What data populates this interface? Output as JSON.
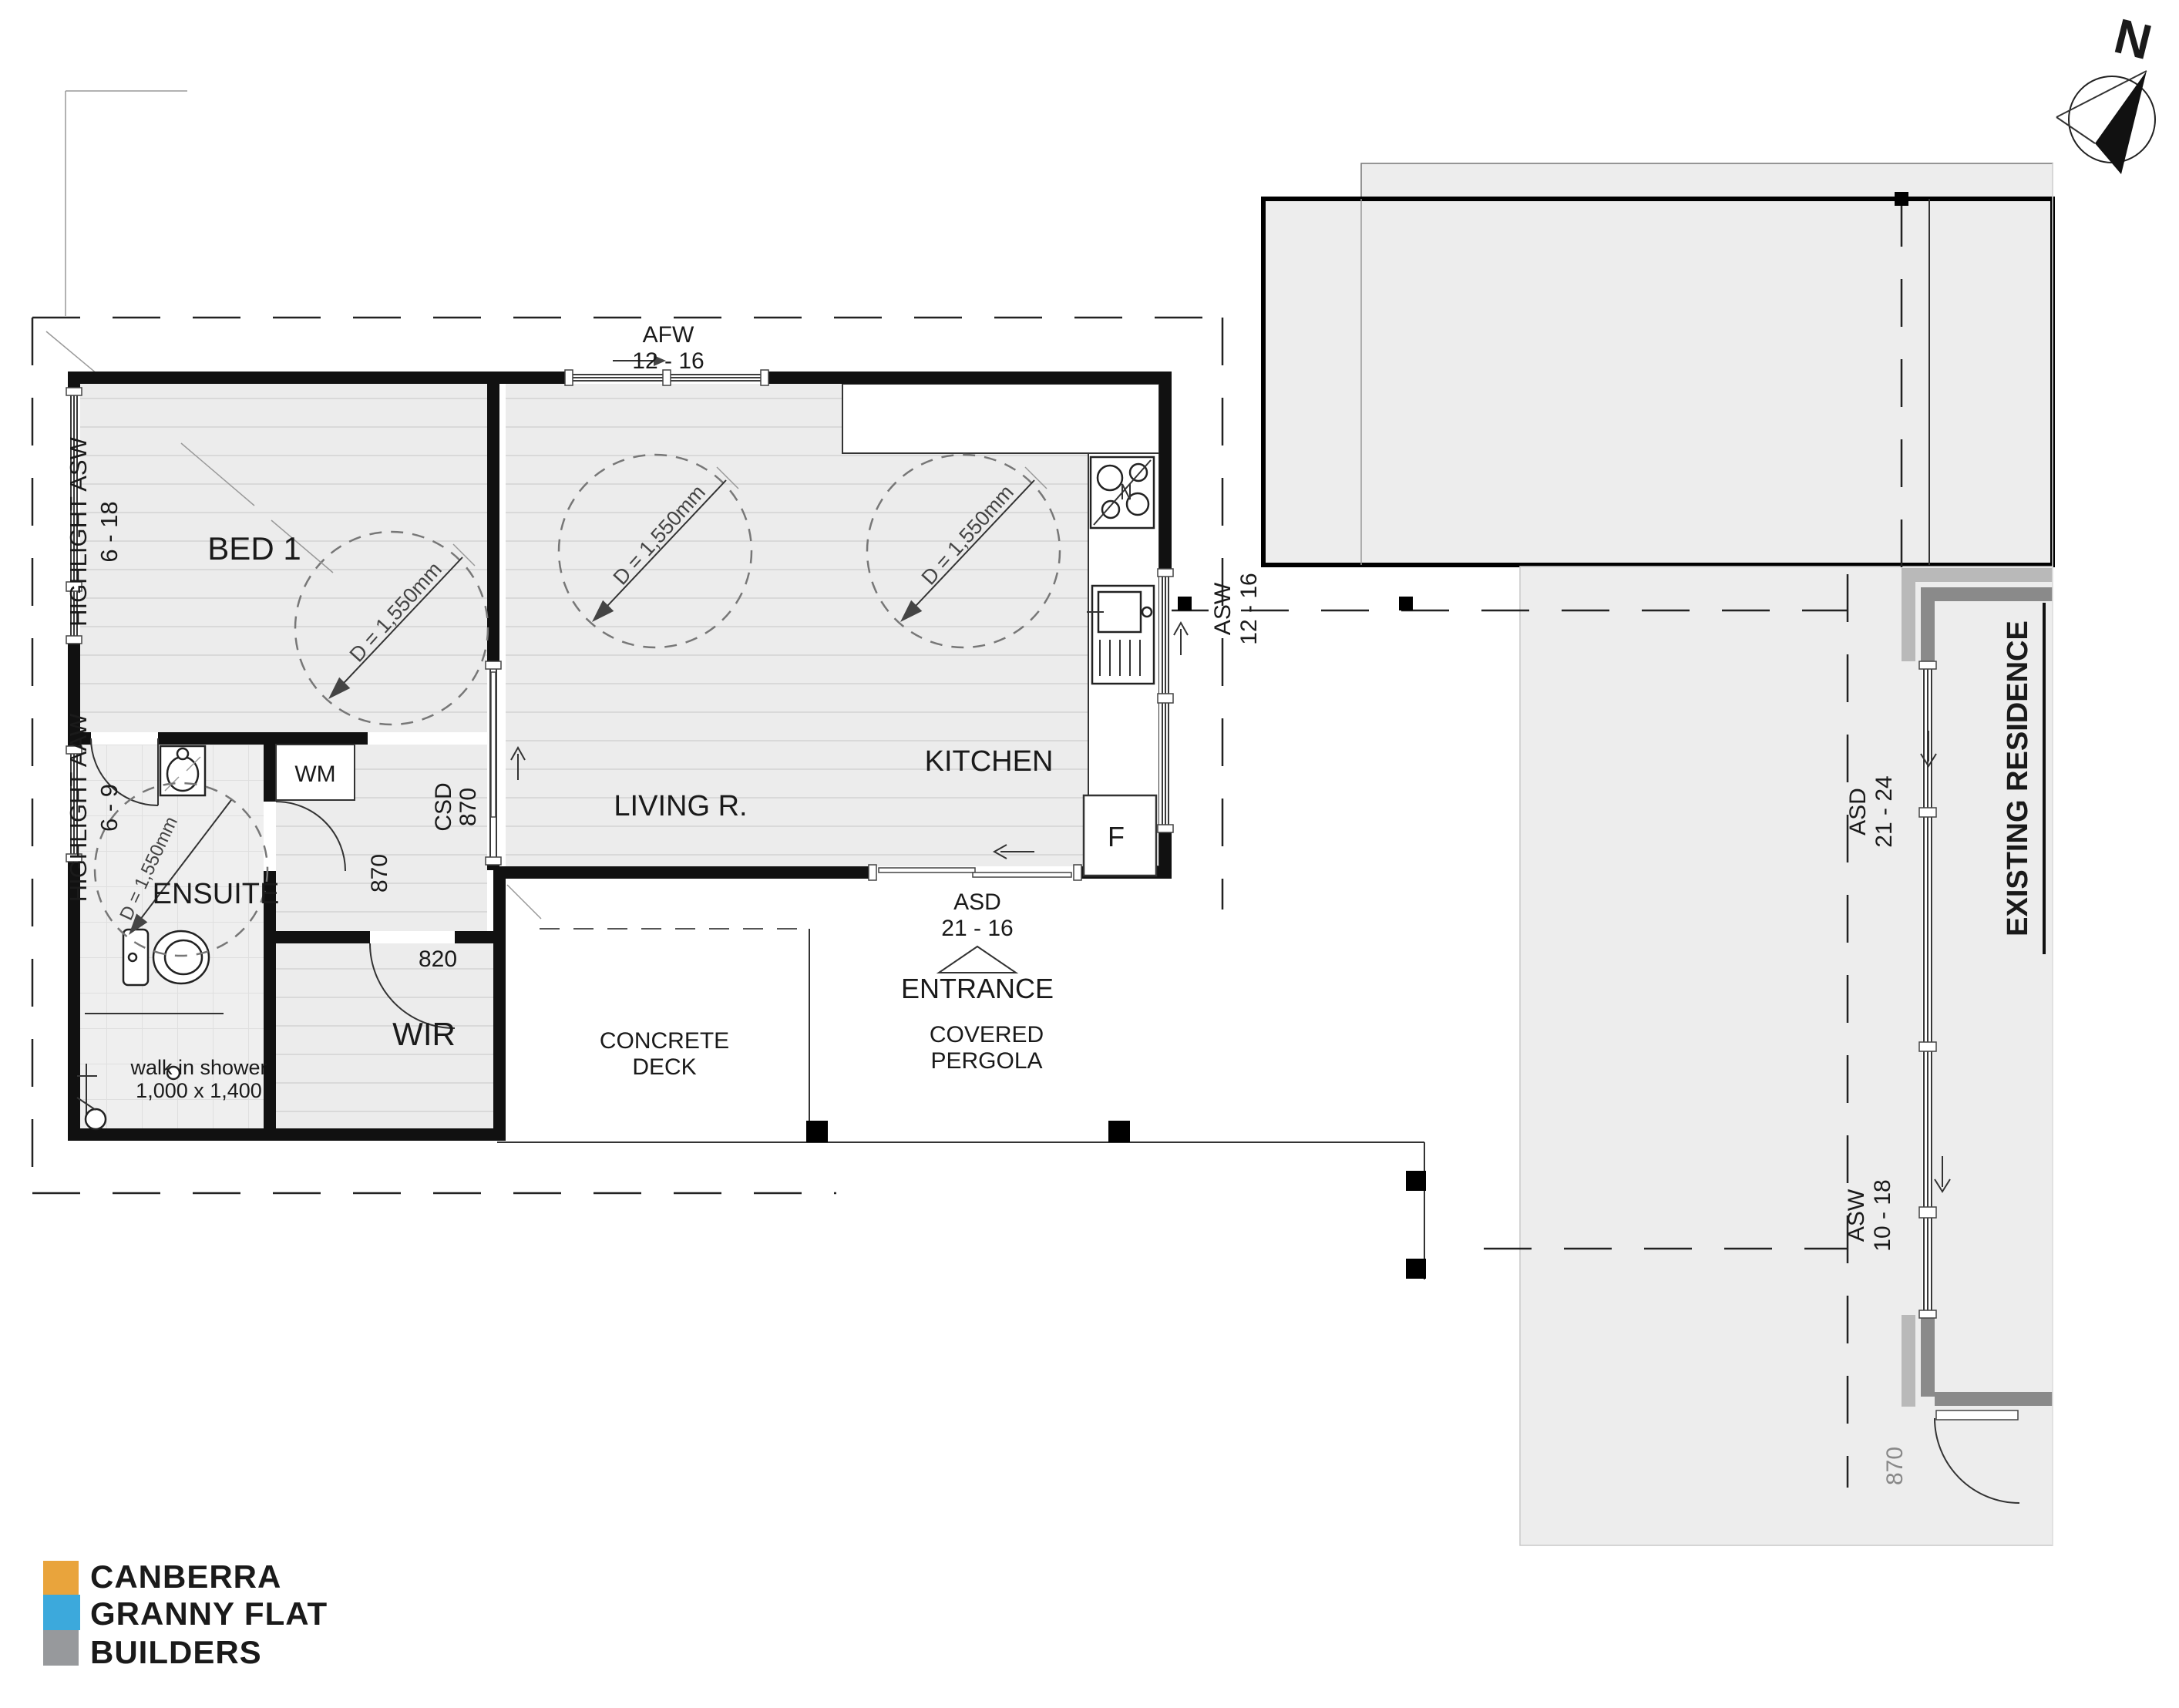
{
  "compass": {
    "north": "N"
  },
  "flat": {
    "rooms": {
      "bed1": "BED 1",
      "ensuite": "ENSUITE",
      "wir": "WIR",
      "living": "LIVING R.",
      "kitchen": "KITCHEN",
      "wm_closet": "WM",
      "fridge": "F"
    },
    "windows": {
      "afw_code": "AFW",
      "afw_size": "12 - 16",
      "highlight_asw_code": "HIGHLIGHT ASW",
      "highlight_asw_size": "6 - 18",
      "highlight_aaw_code": "HIGHLIGHT AAW",
      "highlight_aaw_size": "6 - 9",
      "kitchen_asw_code": "ASW",
      "kitchen_asw_size": "12 - 16"
    },
    "doors": {
      "entry_asd_code": "ASD",
      "entry_asd_size": "21 - 16",
      "csd_code": "CSD",
      "csd_size": "870",
      "ensuite_door_size": "870",
      "wir_door_size": "820"
    },
    "dimensions": {
      "turning_circle": "D = 1,550mm",
      "shower_label": "walk in shower",
      "shower_size": "1,000 x 1,400"
    }
  },
  "outdoor": {
    "entrance": "ENTRANCE",
    "pergola_line1": "COVERED",
    "pergola_line2": "PERGOLA",
    "deck_line1": "CONCRETE",
    "deck_line2": "DECK"
  },
  "residence": {
    "name": "EXISTING RESIDENCE",
    "asd_code": "ASD",
    "asd_size": "21 - 24",
    "asw_code": "ASW",
    "asw_size": "10 - 18",
    "door_size": "870"
  },
  "logo": {
    "line1": "CANBERRA",
    "line2": "GRANNY FLAT",
    "line3": "BUILDERS",
    "color_line1": "#E9A43C",
    "color_line2": "#3CA9DC",
    "color_line3": "#97999C"
  }
}
